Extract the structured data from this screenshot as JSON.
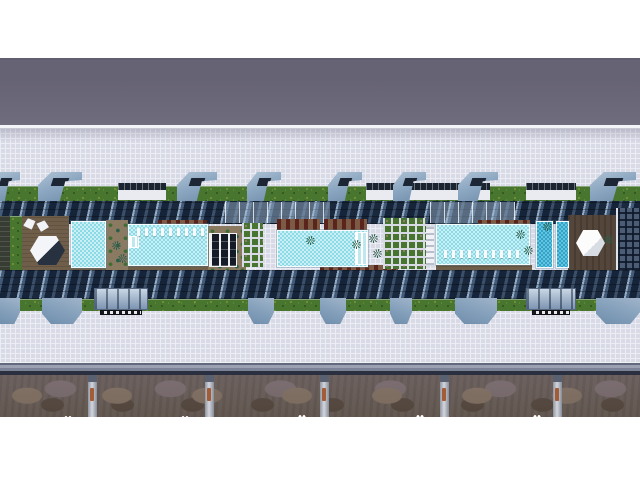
{
  "meta": {
    "title": "Aerial 3D architectural rendering — linear residential podium with rooftop pool deck",
    "type": "architectural-render",
    "width": 640,
    "height": 480,
    "no_visible_text": true
  },
  "palette": {
    "page_bg": "#ffffff",
    "roof_band": "#6b6879",
    "tile_base": "#d8dae6",
    "tile_line": "#ecedf4",
    "hedge": "#49762f",
    "flower": "#e5d14e",
    "canopy": "#8ca7c1",
    "navy": "#24344a",
    "pool_light": "#8bdbe6",
    "pool_deep": "#2ba6cd",
    "deck_brown": "#6f5e49",
    "rock": "#6b6058",
    "rust": "#a25c36"
  },
  "scene": {
    "canopies_top": [
      {
        "x": -10,
        "w": 30
      },
      {
        "x": 38,
        "w": 44
      },
      {
        "x": 177,
        "w": 40
      },
      {
        "x": 247,
        "w": 34
      },
      {
        "x": 328,
        "w": 34
      },
      {
        "x": 393,
        "w": 33
      },
      {
        "x": 458,
        "w": 40
      },
      {
        "x": 590,
        "w": 46
      }
    ],
    "canopies_bottom": [
      {
        "x": -6,
        "w": 26
      },
      {
        "x": 42,
        "w": 40
      },
      {
        "x": 248,
        "w": 26
      },
      {
        "x": 320,
        "w": 26
      },
      {
        "x": 390,
        "w": 22
      },
      {
        "x": 455,
        "w": 42
      },
      {
        "x": 596,
        "w": 44
      }
    ],
    "pavilions_top": [
      {
        "x": 118,
        "w": 48
      },
      {
        "x": 366,
        "w": 124
      },
      {
        "x": 526,
        "w": 50
      }
    ],
    "pavilions_bottom": [
      {
        "x": 94,
        "w": 54
      },
      {
        "x": 526,
        "w": 50
      }
    ],
    "glass_patches": [
      {
        "x": 225,
        "y": 202,
        "w": 105,
        "h": 21
      },
      {
        "x": 430,
        "y": 202,
        "w": 85,
        "h": 21
      },
      {
        "x": 295,
        "y": 271,
        "w": 135,
        "h": 27
      },
      {
        "x": 500,
        "y": 273,
        "w": 60,
        "h": 25
      }
    ],
    "pools": [
      {
        "x": 71,
        "y": 221,
        "w": 35,
        "h": 47,
        "tone": "light"
      },
      {
        "x": 128,
        "y": 224,
        "w": 80,
        "h": 42,
        "tone": "light"
      },
      {
        "x": 277,
        "y": 230,
        "w": 91,
        "h": 37,
        "tone": "light"
      },
      {
        "x": 436,
        "y": 224,
        "w": 94,
        "h": 41,
        "tone": "light"
      },
      {
        "x": 536,
        "y": 221,
        "w": 17,
        "h": 47,
        "tone": "deep"
      },
      {
        "x": 556,
        "y": 221,
        "w": 13,
        "h": 47,
        "tone": "deep"
      }
    ],
    "pool_steps": [
      {
        "x": 355,
        "y": 232,
        "w": 12,
        "h": 33
      },
      {
        "x": 129,
        "y": 236,
        "w": 10,
        "h": 12
      }
    ],
    "lounger_rows": [
      {
        "x": 137,
        "y": 228,
        "count": 9,
        "step": 8
      },
      {
        "x": 444,
        "y": 250,
        "count": 10,
        "step": 8
      }
    ],
    "deck_patches": [
      {
        "x": 0,
        "y": 216,
        "w": 10,
        "h": 56,
        "shade": "planter-dark"
      },
      {
        "x": 10,
        "y": 216,
        "w": 12,
        "h": 56,
        "shade": "hedge-col"
      },
      {
        "x": 22,
        "y": 216,
        "w": 47,
        "h": 54,
        "shade": "brown"
      },
      {
        "x": 106,
        "y": 220,
        "w": 22,
        "h": 50,
        "shade": "brown-light"
      },
      {
        "x": 208,
        "y": 226,
        "w": 38,
        "h": 44,
        "shade": "brown-light"
      },
      {
        "x": 568,
        "y": 215,
        "w": 49,
        "h": 57,
        "shade": "brown-dark"
      },
      {
        "x": 277,
        "y": 219,
        "w": 43,
        "h": 11,
        "shade": "lounge"
      },
      {
        "x": 324,
        "y": 219,
        "w": 43,
        "h": 11,
        "shade": "lounge"
      },
      {
        "x": 158,
        "y": 220,
        "w": 49,
        "h": 8,
        "shade": "lounge"
      },
      {
        "x": 478,
        "y": 220,
        "w": 52,
        "h": 8,
        "shade": "lounge"
      },
      {
        "x": 303,
        "y": 234,
        "w": 16,
        "h": 14,
        "shade": "brown-light"
      },
      {
        "x": 22,
        "y": 265,
        "w": 84,
        "h": 6,
        "shade": "brown"
      },
      {
        "x": 128,
        "y": 266,
        "w": 80,
        "h": 5,
        "shade": "brown"
      },
      {
        "x": 320,
        "y": 265,
        "w": 78,
        "h": 7,
        "shade": "lounge"
      },
      {
        "x": 436,
        "y": 265,
        "w": 96,
        "h": 6,
        "shade": "brown"
      }
    ],
    "pavilion_frame": {
      "x": 209,
      "y": 233,
      "w": 28,
      "h": 34
    },
    "pergola_white": {
      "x": 411,
      "y": 226,
      "w": 24,
      "h": 40
    },
    "planters": [
      {
        "x": 242,
        "y": 223,
        "w": 21,
        "h": 44
      },
      {
        "x": 383,
        "y": 218,
        "w": 43,
        "h": 51
      }
    ],
    "hexagons": [
      {
        "x": 30,
        "y": 236,
        "w": 35,
        "h": 29,
        "variant": "shaded"
      },
      {
        "x": 576,
        "y": 230,
        "w": 29,
        "h": 26,
        "variant": "plain"
      }
    ],
    "umbrellas": [
      {
        "x": 23,
        "y": 218,
        "w": 13,
        "h": 12,
        "rot": -15
      },
      {
        "x": 36,
        "y": 220,
        "w": 13,
        "h": 12,
        "rot": 20
      }
    ],
    "palms": [
      {
        "x": 369,
        "y": 234
      },
      {
        "x": 373,
        "y": 249
      },
      {
        "x": 112,
        "y": 241
      },
      {
        "x": 118,
        "y": 254
      },
      {
        "x": 516,
        "y": 230
      },
      {
        "x": 524,
        "y": 246
      },
      {
        "x": 543,
        "y": 222
      },
      {
        "x": 604,
        "y": 235
      },
      {
        "x": 306,
        "y": 236
      },
      {
        "x": 352,
        "y": 240
      }
    ],
    "building_right": {
      "x": 616,
      "y": 208,
      "w": 24,
      "h": 76
    },
    "stall_dividers_x": [
      88,
      205,
      320,
      440,
      553
    ],
    "stall_dots": [
      {
        "x": 64,
        "y": 412
      },
      {
        "x": 181,
        "y": 412
      },
      {
        "x": 298,
        "y": 411
      },
      {
        "x": 416,
        "y": 411
      },
      {
        "x": 533,
        "y": 411
      }
    ]
  }
}
